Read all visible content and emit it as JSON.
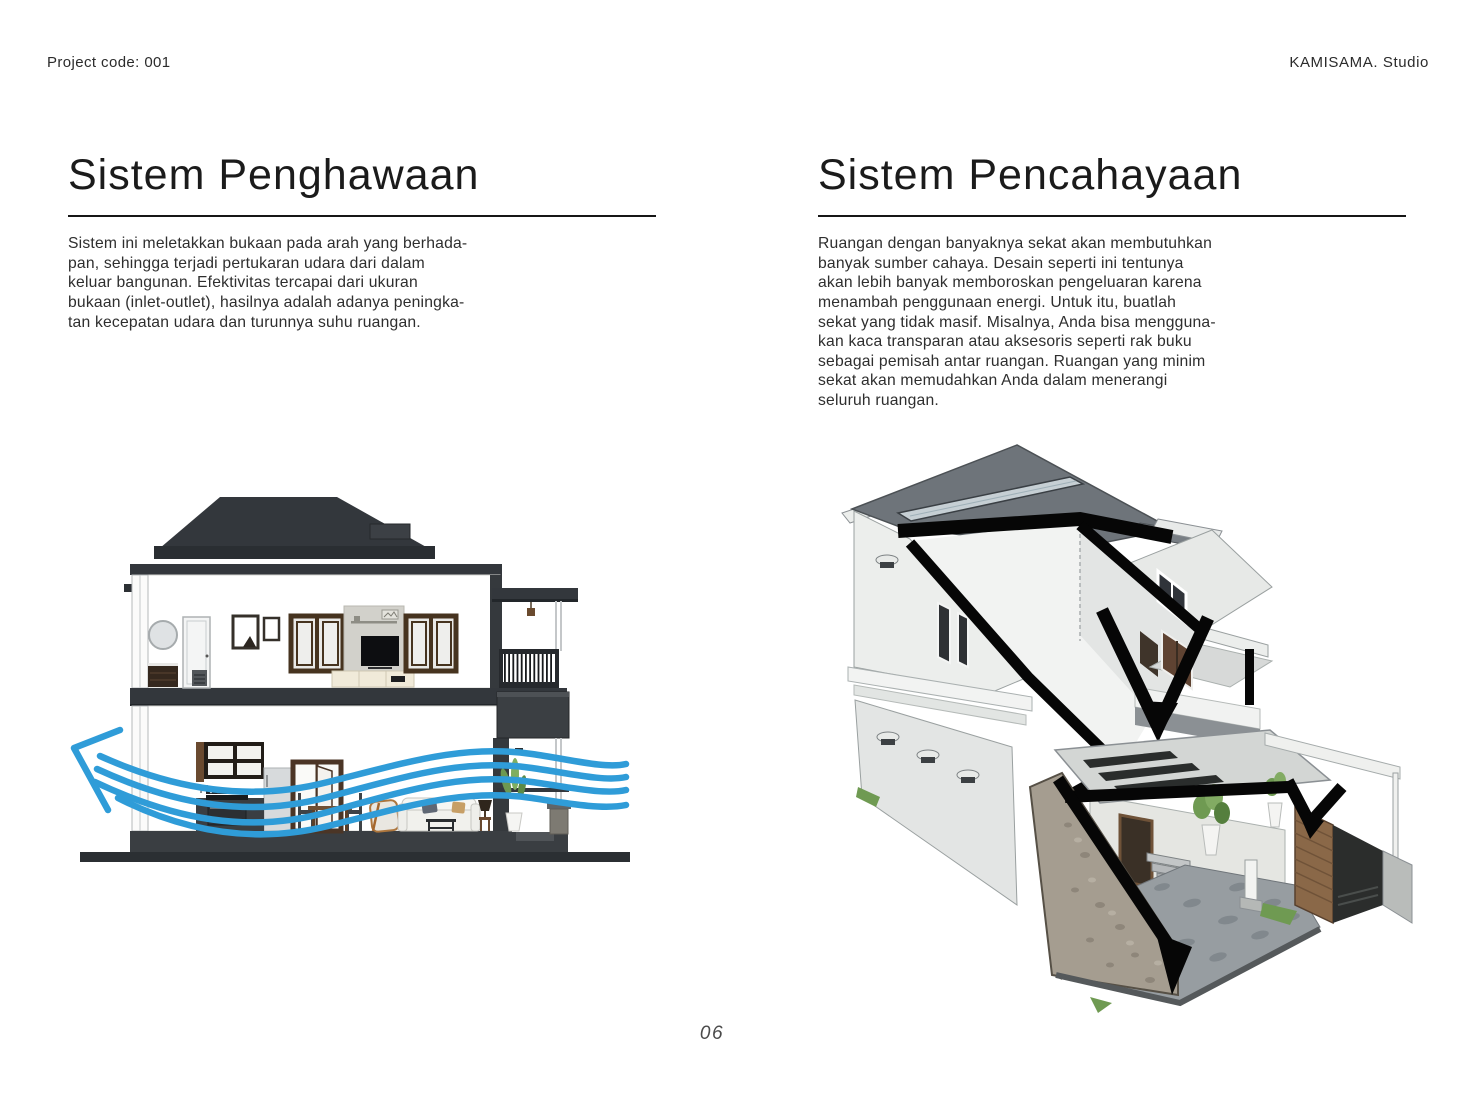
{
  "header": {
    "project_code": "Project code: 001",
    "studio_name": "KAMISAMA. Studio"
  },
  "sections": {
    "ventilation": {
      "title": "Sistem Penghawaan",
      "body": "Sistem ini meletakkan bukaan pada arah yang berhada-\npan, sehingga terjadi pertukaran udara dari dalam\nkeluar bangunan. Efektivitas tercapai dari ukuran\nbukaan (inlet-outlet), hasilnya adalah adanya peningka-\ntan kecepatan udara dan turunnya suhu ruangan.",
      "illustration_icon": "house-section-airflow-illustration"
    },
    "lighting": {
      "title": "Sistem Pencahayaan",
      "body": "Ruangan dengan banyaknya sekat akan membutuhkan\nbanyak sumber cahaya. Desain seperti ini tentunya\nakan lebih banyak memboroskan pengeluaran karena\nmenambah penggunaan energi. Untuk itu, buatlah\nsekat yang tidak masif. Misalnya, Anda bisa mengguna-\nkan kaca transparan atau aksesoris seperti rak buku\nsebagai pemisah antar ruangan. Ruangan yang minim\nsekat akan memudahkan Anda dalam menerangi\nseluruh ruangan.",
      "illustration_icon": "isometric-cutaway-daylight-illustration"
    }
  },
  "footer": {
    "page_number": "06"
  },
  "colors": {
    "airflow_blue": "#2F9CD8",
    "ink": "#1B1B1B",
    "daylight_arrow_black": "#060606",
    "roof_dark": "#33373C"
  }
}
